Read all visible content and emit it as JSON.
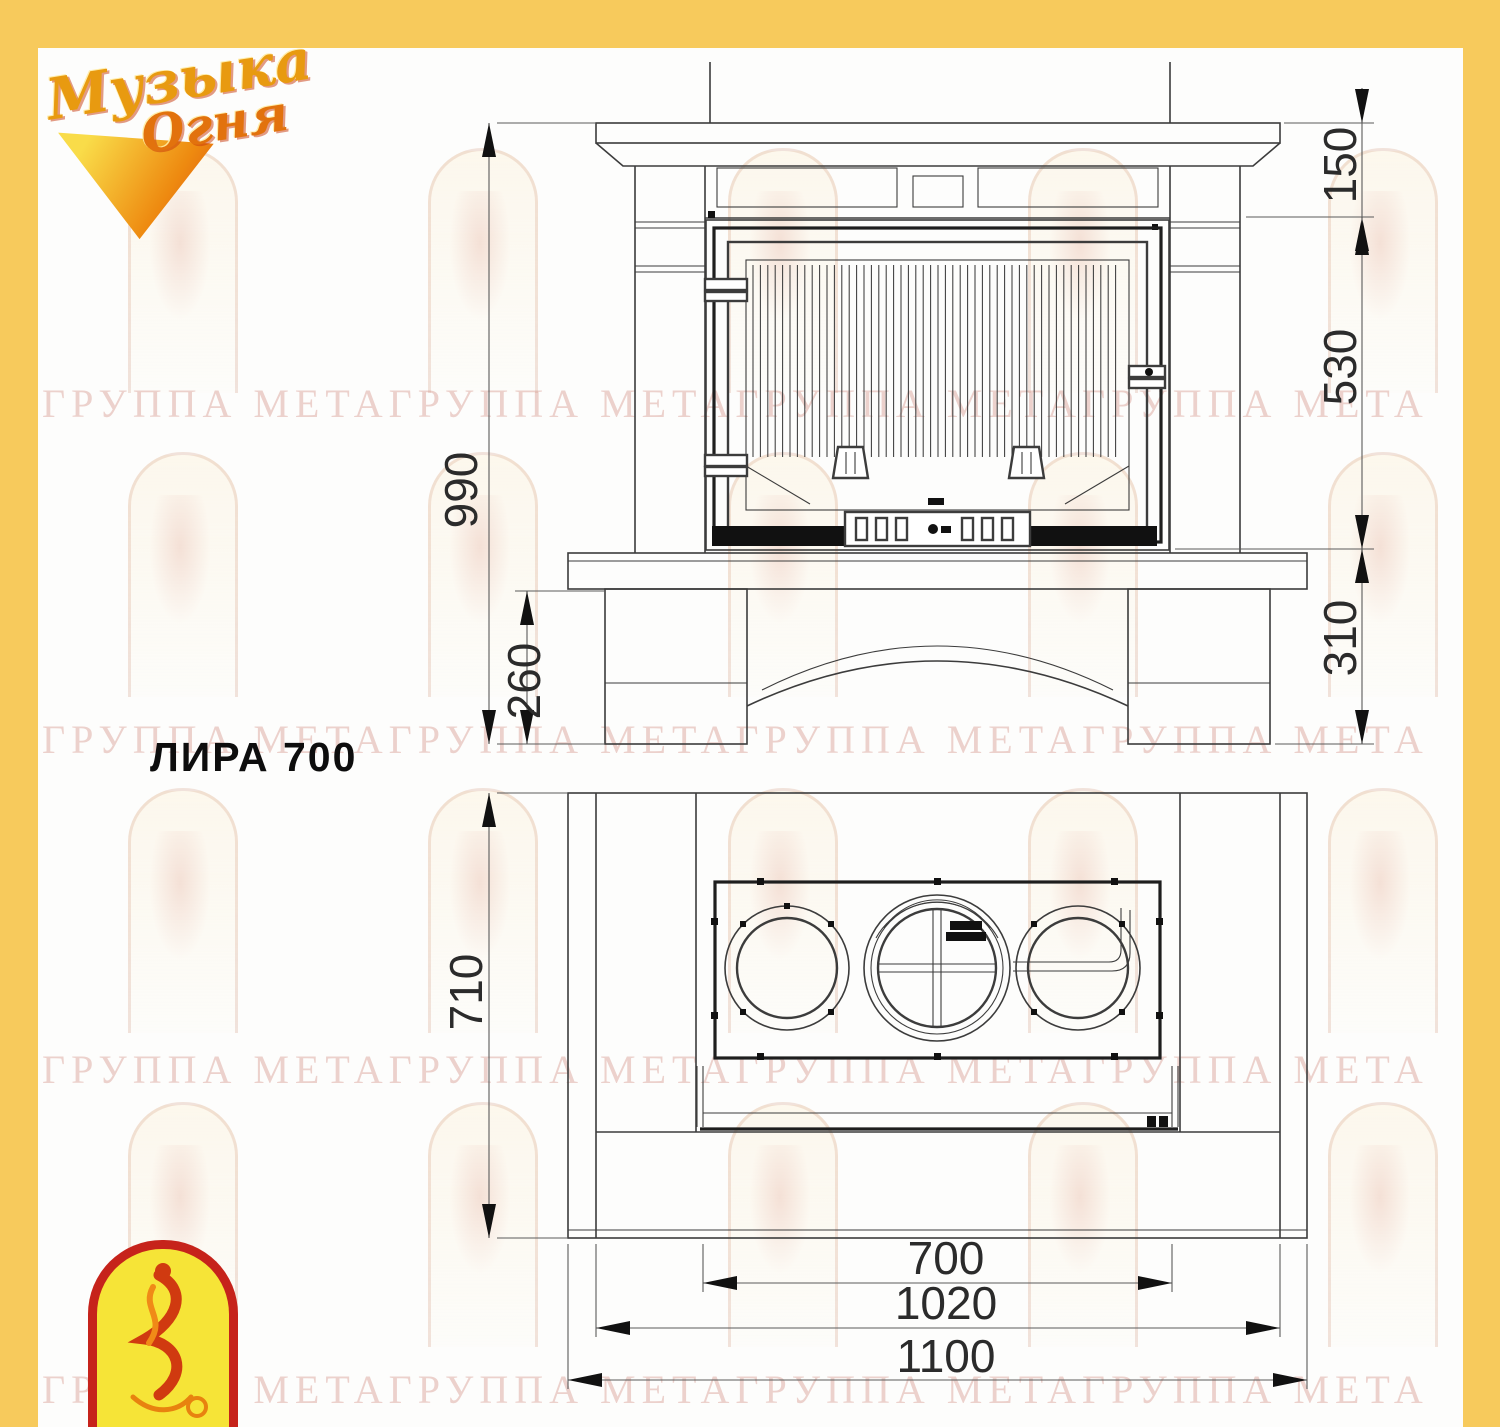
{
  "title": "ЛИРА 700",
  "logo": {
    "line1": "Музыка",
    "line2": "Огня"
  },
  "watermark": {
    "text": "ГРУППА МЕТАГРУППА МЕТАГРУППА МЕТАГРУППА МЕТА"
  },
  "dimensions": {
    "total_height": "990",
    "mantel_height": "150",
    "firebox_height": "530",
    "hearth_height": "310",
    "base_height": "260",
    "depth": "710",
    "firebox_width": "700",
    "inner_width": "1020",
    "total_width": "1100"
  },
  "colors": {
    "frame": "#F7CA5C",
    "drawing_line": "#3c3c3c",
    "dimension_text": "#2b2b2b",
    "watermark_text": "#D18E84",
    "logo_gold": "#E89A10",
    "logo_orange": "#E2720D",
    "emblem_border_red": "#C6231B",
    "emblem_yellow": "#F6E437"
  }
}
